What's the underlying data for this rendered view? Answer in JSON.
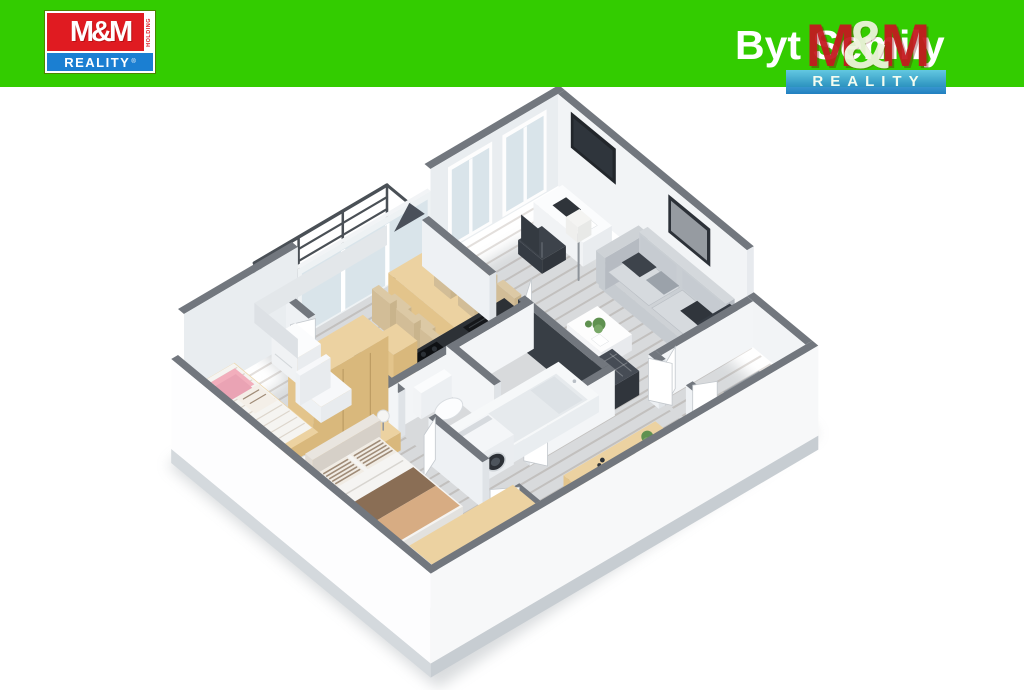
{
  "header": {
    "bg_color": "#33cc00",
    "logo_left": {
      "brand": "M&M",
      "holding": "HOLDING",
      "reality": "REALITY",
      "reg": "®",
      "red": "#e01b21",
      "blue": "#1b7fd2"
    },
    "title": "Byt Semily",
    "logo_right": {
      "m1": "M",
      "amp": "&",
      "m2": "M",
      "reality": "REALITY",
      "red": "#c4181f",
      "amp_color": "#edf3dc",
      "blue_top": "#66c8ef",
      "blue_bottom": "#1478bd"
    }
  },
  "floorplan": {
    "description": "3D isometric floor plan of a furnished apartment",
    "colors": {
      "wallTop": "#72777e",
      "wallFaceNE": "#f2f4f6",
      "wallFaceNW": "#e9edf0",
      "wallFaceIn": "#f3f5f7",
      "wallFaceIn2": "#eef1f4",
      "wallCap": "#dfe3e7",
      "wallExt": "#f7f8f9",
      "slab": "#c7cdd2",
      "slab2": "#d4d9dd",
      "woodLiving": "#a2876a",
      "woodDining": "#b2977a",
      "woodHall": "#ad9278",
      "woodKids": "#b2977a",
      "woodBed": "#a2876a",
      "streak": "rgba(80,58,38,0.16)",
      "bathFloor": "#d7dbde",
      "balcFloor": "#ccd1d5",
      "rail": "#4a5056",
      "glass": "#d9e4ea",
      "rugLiving": "#b4bac1",
      "rugBed": "#9ca3ab",
      "tanTop": "#ecd2a1",
      "tanSide": "#d9b87c",
      "tanFront": "#e3c48b",
      "counterTop": "#2d3136",
      "counterDark": "#15171a",
      "white": "#ffffff",
      "softWhite": "#f6f7f8",
      "sofaTop": "#ced2d6",
      "sofaSide": "#b6bbc2",
      "sofaFront": "#c6cbd0",
      "dark": "#3d434b",
      "darker": "#30353c",
      "pink": "#f2aebc",
      "linen": "#f5f4f1",
      "stripe": "#a08c78",
      "throwTan": "#d7ac83",
      "throwBrown": "#8a6e55",
      "plant": "#5f9150",
      "plantLight": "#79a868",
      "tiles": "#383e45",
      "steel": "#b9bfc6",
      "chairSeat": "#dcc9a5",
      "chairSide": "#c9b48c",
      "shadow": "#9aa0a6"
    }
  }
}
